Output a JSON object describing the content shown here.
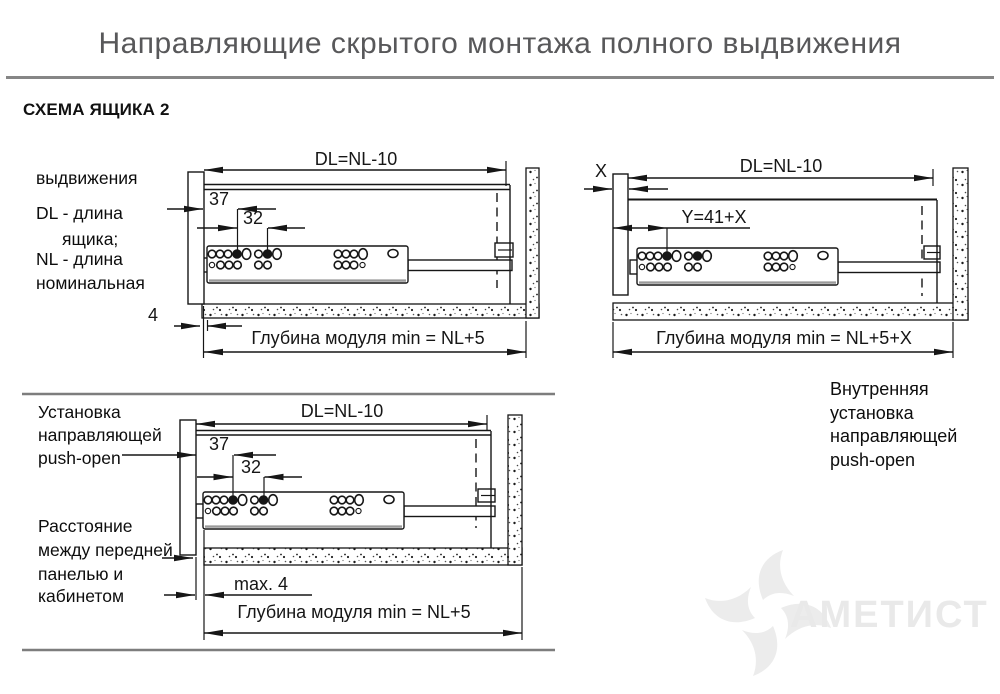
{
  "header": {
    "title": "Направляющие скрытого монтажа полного выдвижения",
    "section": "СХЕМА ЯЩИКА 2"
  },
  "diagram1": {
    "notes": [
      "выдвижения",
      "DL - длина",
      "ящика;",
      "NL - длина",
      "номинальная"
    ],
    "dims": {
      "top": "DL=NL-10",
      "d37": "37",
      "d32": "32",
      "d4": "4",
      "bottom": "Глубина модуля min = NL+5"
    }
  },
  "diagram2": {
    "dims": {
      "x": "X",
      "top": "DL=NL-10",
      "y": "Y=41+X",
      "bottom": "Глубина модуля min = NL+5+X"
    },
    "notes": [
      "Внутренняя",
      "установка",
      "направляющей",
      "push-open"
    ]
  },
  "diagram3": {
    "notes_top": [
      "Установка",
      "направляющей",
      "push-open"
    ],
    "notes_bottom": [
      "Расстояние",
      "между передней",
      "панелью и",
      "кабинетом"
    ],
    "dims": {
      "top": "DL=NL-10",
      "d37": "37",
      "d32": "32",
      "max4": "max. 4",
      "bottom": "Глубина модуля min = NL+5"
    }
  },
  "watermark": {
    "brand": "АМЕТИСТ"
  },
  "colors": {
    "title": "#58585a",
    "divider": "#868686",
    "line": "#161616",
    "watermark": "#e9e9e9"
  }
}
